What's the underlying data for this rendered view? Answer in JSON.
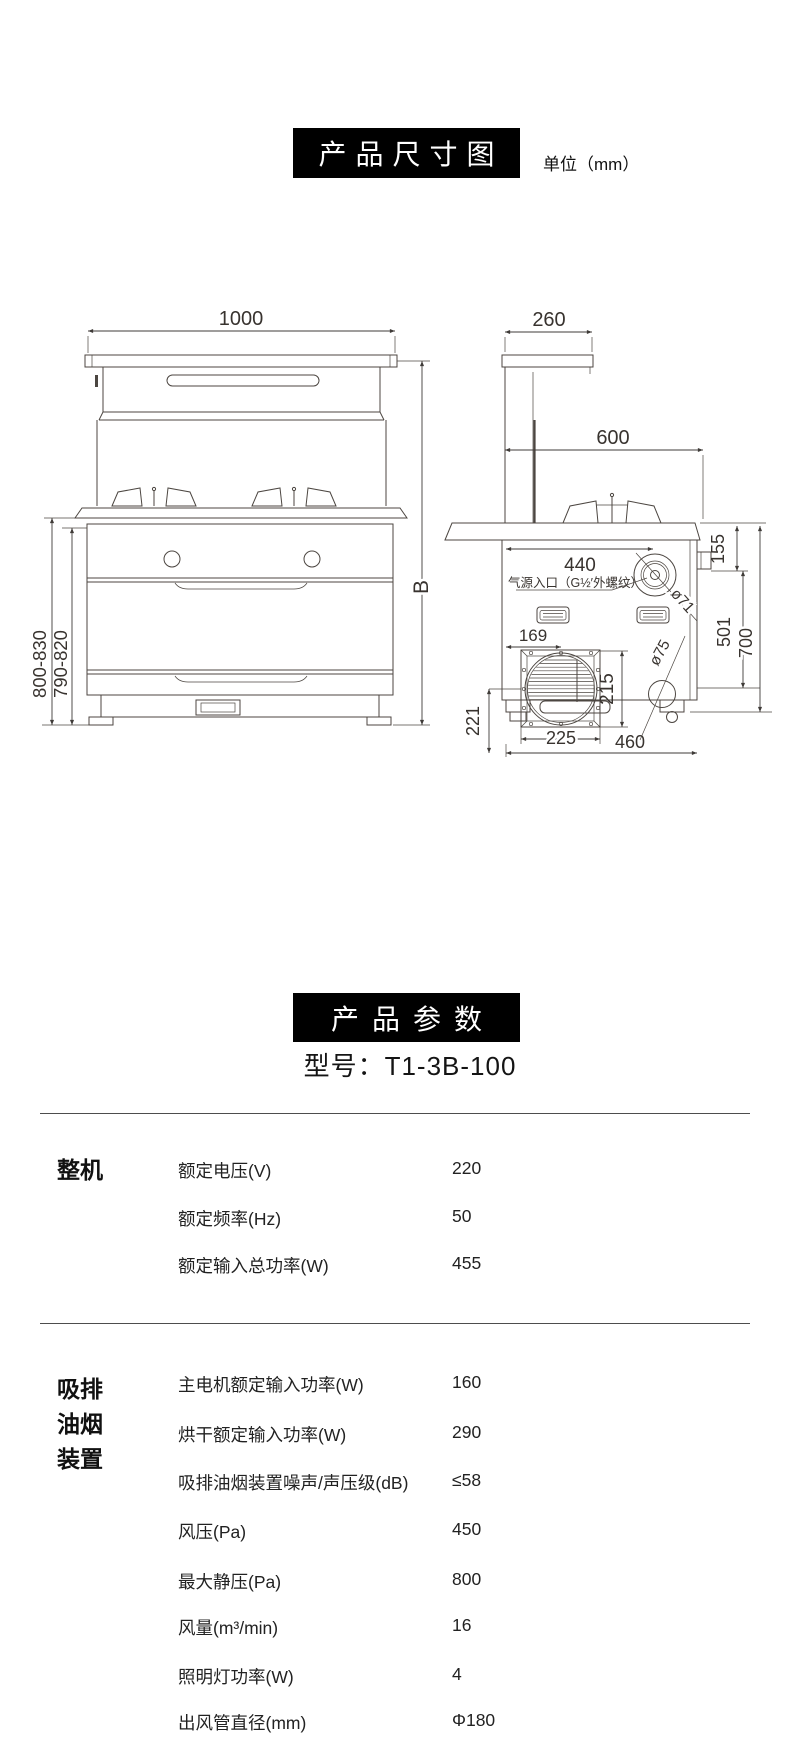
{
  "header": {
    "dimensions_title": "产品尺寸图",
    "unit_label": "单位（mm）"
  },
  "parameters": {
    "title": "产品参数",
    "model": "型号：T1-3B-100"
  },
  "drawing": {
    "front": {
      "w1000": "1000",
      "h_outer": "800-830",
      "h_inner": "790-820",
      "hB": "B"
    },
    "side": {
      "d260": "260",
      "d600": "600",
      "d440": "440",
      "gas": "气源入口（G½′外螺纹）",
      "dia71": "ø71",
      "dia75": "ø75",
      "d155": "155",
      "d501": "501",
      "d700": "700",
      "d169": "169",
      "d215": "215",
      "d221": "221",
      "d225": "225",
      "d460": "460"
    }
  },
  "spec_table": {
    "groups": [
      {
        "category": "整机",
        "rows": [
          {
            "label": "额定电压(V)",
            "value": "220"
          },
          {
            "label": "额定频率(Hz)",
            "value": "50"
          },
          {
            "label": "额定输入总功率(W)",
            "value": "455"
          }
        ]
      },
      {
        "category": "吸排油烟装置",
        "rows": [
          {
            "label": "主电机额定输入功率(W)",
            "value": "160"
          },
          {
            "label": "烘干额定输入功率(W)",
            "value": "290"
          },
          {
            "label": "吸排油烟装置噪声/声压级(dB)",
            "value": "≤58"
          },
          {
            "label": "风压(Pa)",
            "value": "450"
          },
          {
            "label": "最大静压(Pa)",
            "value": "800"
          },
          {
            "label": "风量(m³/min)",
            "value": "16"
          },
          {
            "label": "照明灯功率(W)",
            "value": "4"
          },
          {
            "label": "出风管直径(mm)",
            "value": "Φ180"
          }
        ]
      }
    ]
  }
}
